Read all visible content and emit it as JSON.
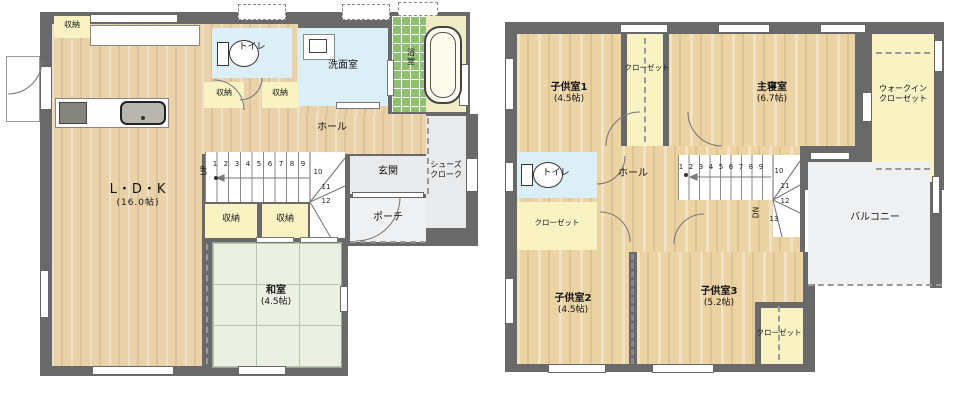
{
  "colors": {
    "wall": "#696969",
    "wood_floor": "#e9d2a9",
    "tatami": "#ebf0e3",
    "wet_room_blue": "#dceef6",
    "closet_yellow": "#f9f3c4",
    "bath_tile_green": "#8fbf70",
    "entry_gray": "#e8eaec"
  },
  "floor1": {
    "rooms": {
      "ldk": {
        "name": "L・D・K",
        "size": "(16.0帖)"
      },
      "washitsu": {
        "name": "和室",
        "size": "(4.5帖)"
      },
      "toilet": {
        "name": "トイレ"
      },
      "senmen": {
        "name": "洗面室"
      },
      "bath": {
        "name": "浴室"
      },
      "hall": {
        "name": "ホール"
      },
      "genkan": {
        "name": "玄関"
      },
      "porch": {
        "name": "ポーチ"
      },
      "shoes_cloak": {
        "line1": "シューズ",
        "line2": "クローク"
      },
      "storage": "収納"
    },
    "stairs": {
      "direction": "UP",
      "steps": [
        "1",
        "2",
        "3",
        "4",
        "5",
        "6",
        "7",
        "8",
        "9",
        "10",
        "11",
        "12"
      ]
    }
  },
  "floor2": {
    "rooms": {
      "kids1": {
        "name": "子供室1",
        "size": "(4.5帖)"
      },
      "kids2": {
        "name": "子供室2",
        "size": "(4.5帖)"
      },
      "kids3": {
        "name": "子供室3",
        "size": "(5.2帖)"
      },
      "master": {
        "name": "主寝室",
        "size": "(6.7帖)"
      },
      "wic": {
        "line1": "ウォークイン",
        "line2": "クローゼット"
      },
      "closet": "クローゼット",
      "toilet": {
        "name": "トイレ"
      },
      "hall": {
        "name": "ホール"
      },
      "balcony": {
        "name": "バルコニー"
      }
    },
    "stairs": {
      "direction": "DN",
      "steps": [
        "1",
        "2",
        "3",
        "4",
        "5",
        "6",
        "7",
        "8",
        "9",
        "10",
        "11",
        "12",
        "13"
      ]
    }
  }
}
